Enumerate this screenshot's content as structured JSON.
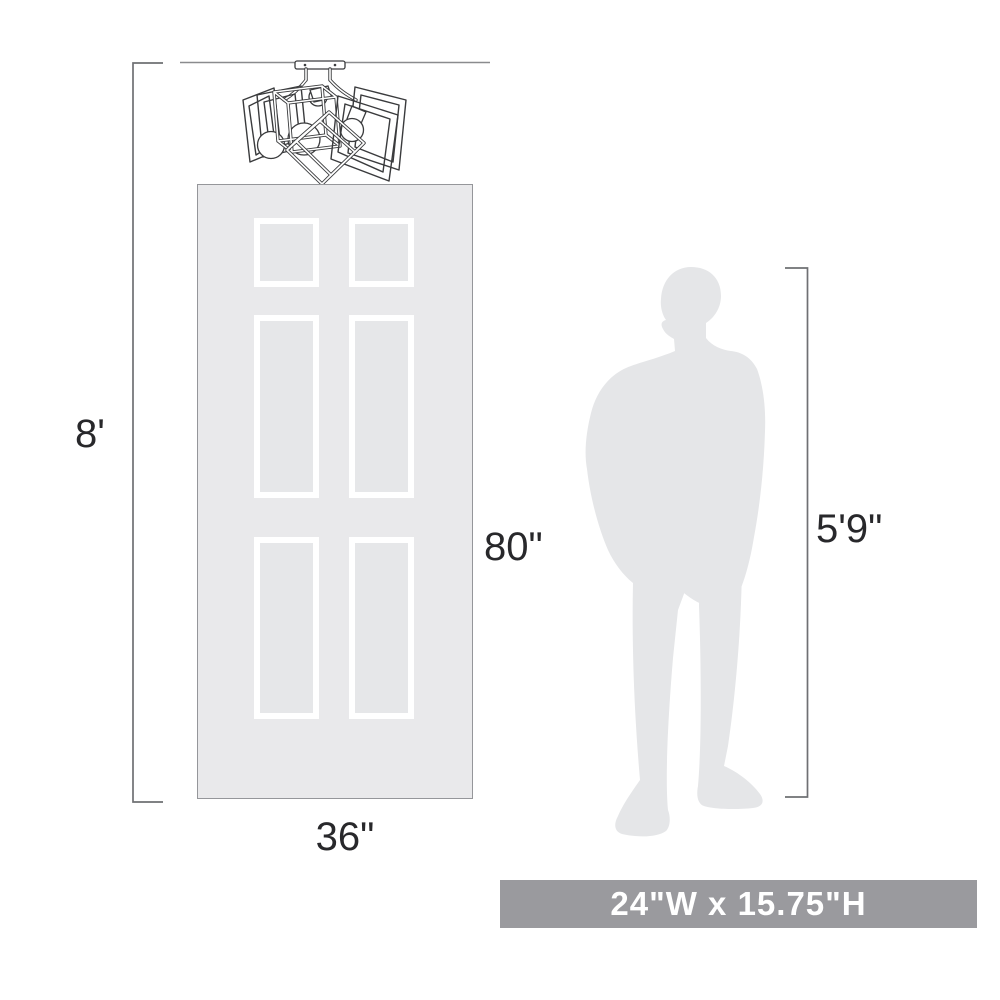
{
  "illustration": {
    "type": "product-scale-dimension-diagram",
    "labels": {
      "ceiling_height": "8'",
      "door_height": "80\"",
      "door_width": "36\"",
      "person_height": "5'9\"",
      "fixture_size": "24\"W x 15.75\"H"
    },
    "icons": {
      "fixture": "ceiling-light-fixture-line-art",
      "door": "six-panel-door-silhouette",
      "person": "standing-man-silhouette"
    },
    "colors": {
      "background": "#ffffff",
      "door_fill": "#e9e9eb",
      "door_panel_fill": "#e6e7e9",
      "door_panel_frame": "#ffffff",
      "door_border": "#95969a",
      "person_fill": "#e5e6e8",
      "ceiling_line": "#8a8b8e",
      "dimension_line": "#6f7073",
      "label_text": "#28282b",
      "fixture_stroke": "#3a3b3d",
      "banner_background": "#9a9a9e",
      "banner_text": "#ffffff"
    }
  }
}
